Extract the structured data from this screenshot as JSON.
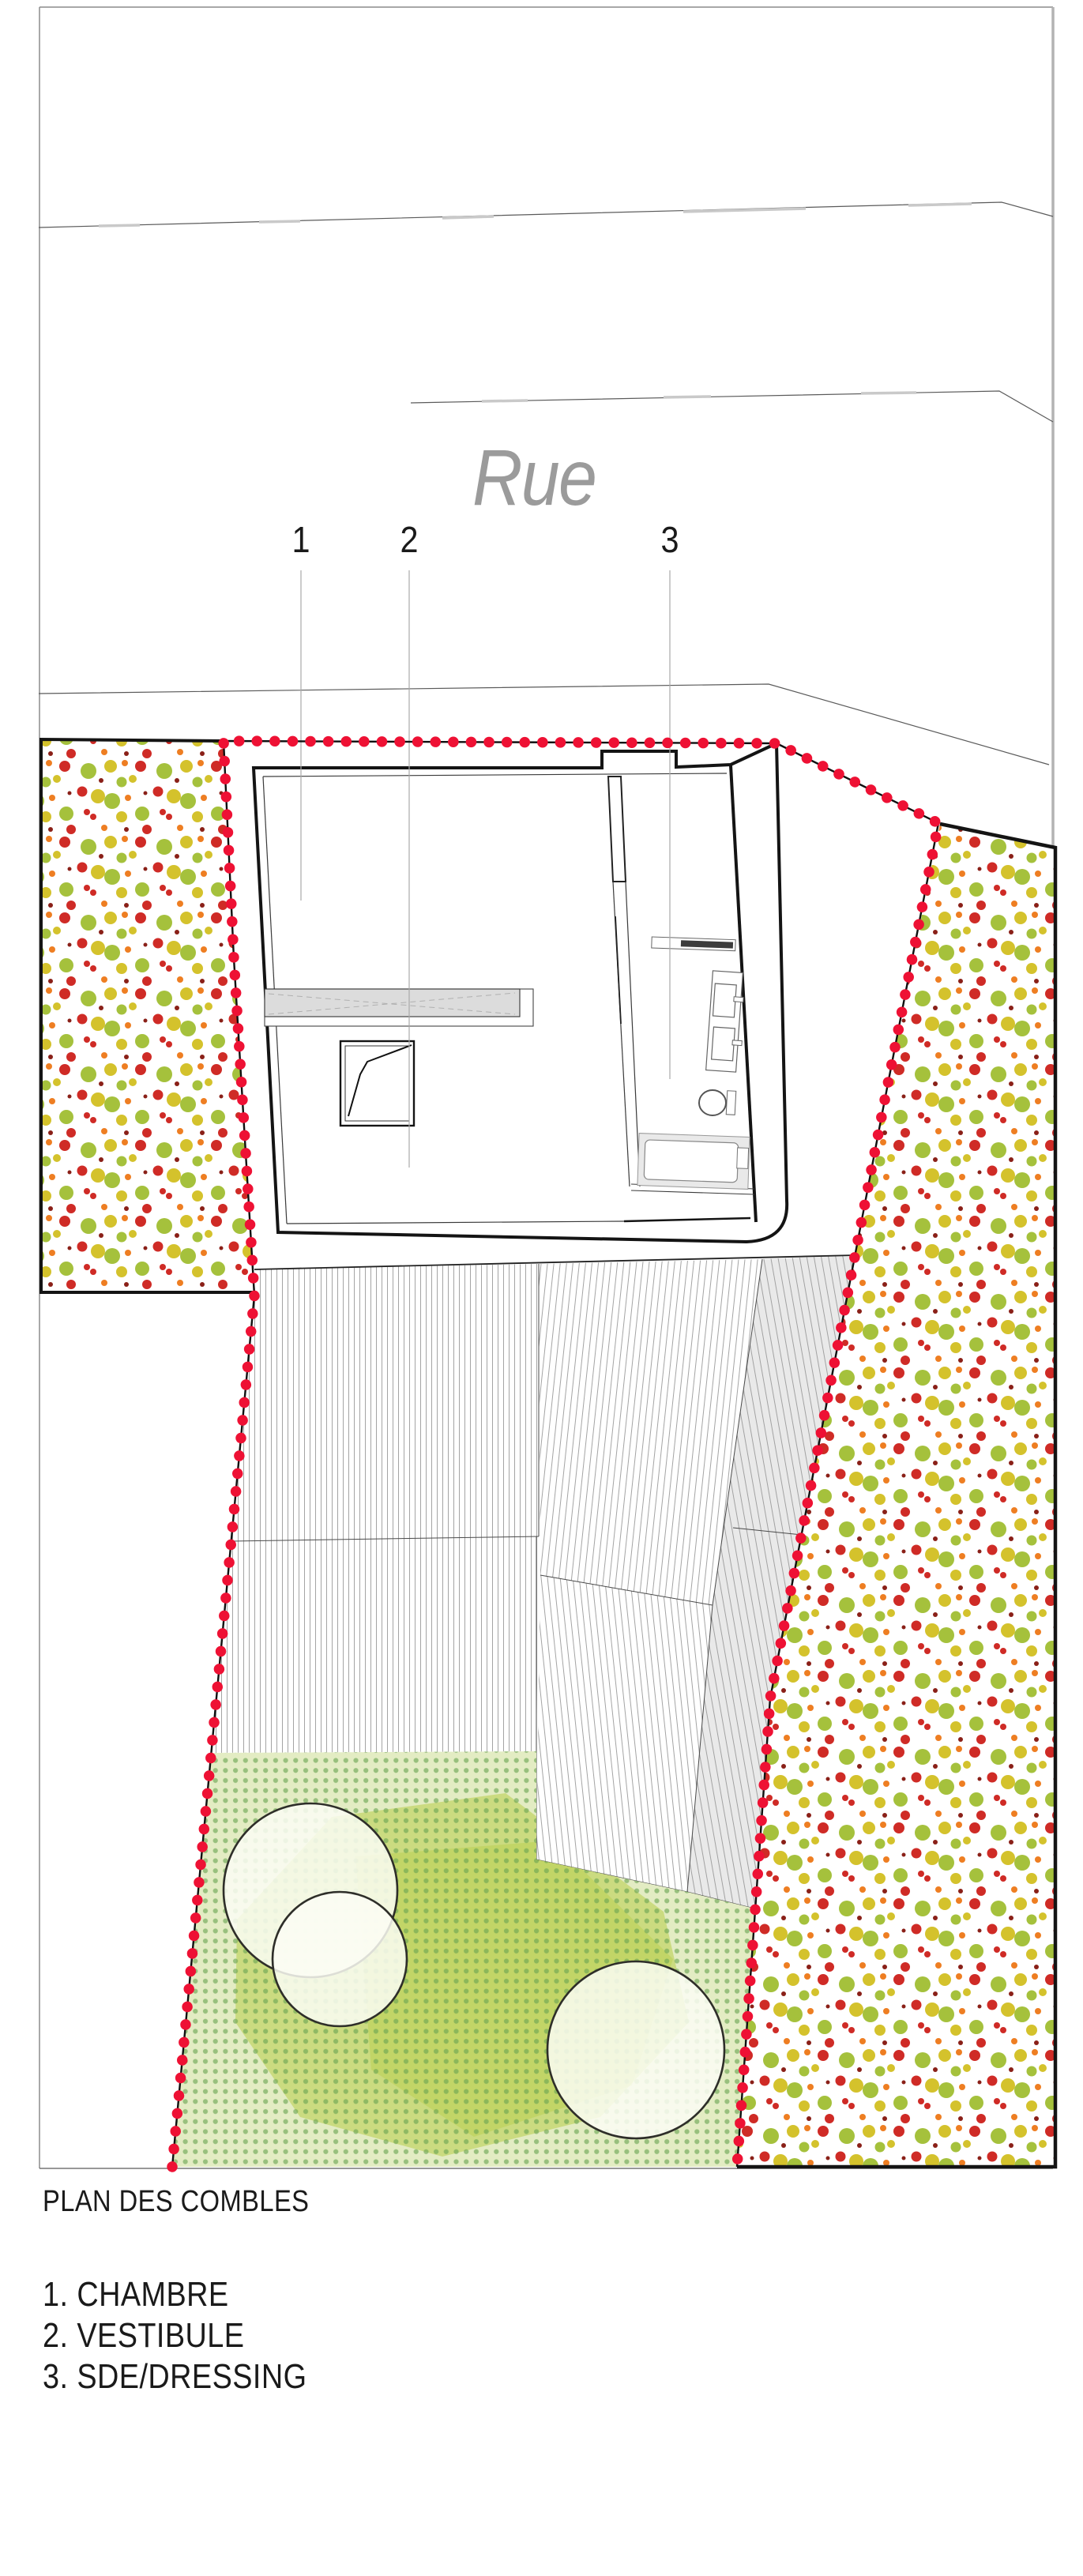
{
  "drawing": {
    "street_label": "Rue",
    "plan_title": "PLAN DES COMBLES",
    "legend_items": [
      "1. CHAMBRE",
      "2. VESTIBULE",
      "3. SDE/DRESSING"
    ],
    "callouts": [
      "1",
      "2",
      "3"
    ]
  },
  "colors": {
    "boundary_red": "#ee1134",
    "dot_green": "#a5c13c",
    "dot_yellow": "#d4c22c",
    "dot_red": "#cf2b26",
    "dot_orange": "#ee7e22",
    "dot_darkred": "#8a2018",
    "garden_base": "#e3ecc3",
    "garden_dot": "#6aa552",
    "garden_blob": "#b3ca3e",
    "tree_fill": "#fbfdf4",
    "tree_stroke": "#2e2e29",
    "wall": "#141414",
    "thin": "#3a3a3a",
    "leader": "#a9a9a9",
    "street": "#5a5a5a",
    "street_curb": "#c9c9c9",
    "hatch": "#9a9a9a",
    "band_gray": "#e9e9e9",
    "counter_gray": "#dcdcdc",
    "fixture": "#666666",
    "frame": "#8b8b8b",
    "frame_right": "#b3b3b3",
    "text": "#1a1a1a",
    "rue": "#9b9b9b"
  }
}
